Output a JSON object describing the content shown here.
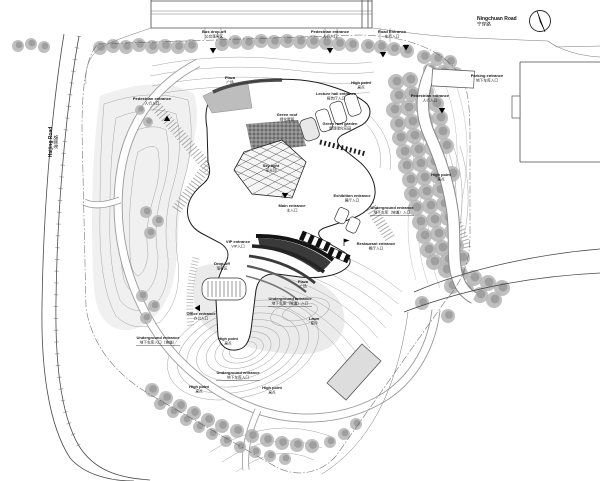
{
  "meta": {
    "title": "Architectural site plan — cultural center with landscaped park"
  },
  "colors": {
    "paper": "#ffffff",
    "ink": "#1c1c1c",
    "contour": "#a5a5a5",
    "tree": "#b3b3b3",
    "dark_canopy": "#2f2f2f",
    "plaza_gray": "#bdbdbd",
    "parcel_building": "#dddddd"
  },
  "north_arrow": {
    "name": "north-arrow"
  },
  "labels": [
    {
      "id": "ningchuan-road",
      "en": "Ningchuan Road",
      "zh": "宁穿路",
      "x": 477,
      "y": 20,
      "anchor": "start",
      "size": 5
    },
    {
      "id": "haijing-road",
      "en": "Haijing Road",
      "zh": "海景路",
      "x": 52,
      "y": 142,
      "rot": -90,
      "size": 5
    },
    {
      "id": "bus-dropoff-entrance",
      "en": "Bus drop-off",
      "zh": "公交落客区",
      "x": 214,
      "y": 33
    },
    {
      "id": "pedestrian-entrance-north",
      "en": "Pedestrian entrance",
      "zh": "人行入口",
      "x": 330,
      "y": 33
    },
    {
      "id": "road-entrance",
      "en": "Road Entrance",
      "zh": "车行入口",
      "x": 392,
      "y": 33
    },
    {
      "id": "parking-entrance-east",
      "en": "Parking entrance",
      "zh": "地下车库入口",
      "x": 487,
      "y": 77
    },
    {
      "id": "pedestrian-path-east",
      "en": "Pedestrian entrance",
      "zh": "人行入口",
      "x": 430,
      "y": 97
    },
    {
      "id": "lecture-hall-entrance",
      "en": "Lecture hall entrance",
      "zh": "报告厅入口",
      "x": 336,
      "y": 95
    },
    {
      "id": "roof-garden",
      "en": "Green roof garden",
      "zh": "屋顶绿化花园",
      "x": 340,
      "y": 125
    },
    {
      "id": "green-roof-band",
      "en": "Green roof",
      "zh": "绿化屋面",
      "x": 287,
      "y": 116
    },
    {
      "id": "plaza-north",
      "en": "Plaza",
      "zh": "广场",
      "x": 230,
      "y": 79
    },
    {
      "id": "skylight",
      "en": "Sky light",
      "zh": "采光顶",
      "x": 271,
      "y": 167
    },
    {
      "id": "main-entrance",
      "en": "Main entrance",
      "zh": "主入口",
      "x": 292,
      "y": 207
    },
    {
      "id": "exhibition-entrance",
      "en": "Exhibition entrance",
      "zh": "展厅入口",
      "x": 352,
      "y": 197
    },
    {
      "id": "underground-entrance-east",
      "en": "Underground entrance",
      "zh": "地下车库（坡道）入口",
      "x": 392,
      "y": 209,
      "u": true
    },
    {
      "id": "restaurant-entrance",
      "en": "Restaurant entrance",
      "zh": "餐厅入口",
      "x": 376,
      "y": 245
    },
    {
      "id": "high-point-ne",
      "en": "High point",
      "zh": "高点",
      "x": 441,
      "y": 176
    },
    {
      "id": "high-point-n",
      "en": "High point",
      "zh": "高点",
      "x": 361,
      "y": 84
    },
    {
      "id": "high-point-c",
      "en": "High point",
      "zh": "高点",
      "x": 228,
      "y": 340
    },
    {
      "id": "high-point-sw",
      "en": "High point",
      "zh": "高点",
      "x": 199,
      "y": 388
    },
    {
      "id": "high-point-se",
      "en": "High point",
      "zh": "高点",
      "x": 272,
      "y": 389
    },
    {
      "id": "office-entrance",
      "en": "Office entrance",
      "zh": "办公入口",
      "x": 201,
      "y": 315
    },
    {
      "id": "underground-entrance-sw",
      "en": "Underground entrance",
      "zh": "地下车库入口（坡道）",
      "x": 158,
      "y": 339,
      "u": true
    },
    {
      "id": "underground-entrance-s",
      "en": "Underground entrance",
      "zh": "地下车库（坡道）入口",
      "x": 290,
      "y": 300,
      "u": true
    },
    {
      "id": "underground-entrance-sw2",
      "en": "Underground entrance",
      "zh": "地下车库入口",
      "x": 238,
      "y": 374,
      "u": true
    },
    {
      "id": "plaza-south",
      "en": "Plaza",
      "zh": "广场",
      "x": 303,
      "y": 283
    },
    {
      "id": "lawn-south",
      "en": "Lawn",
      "zh": "草坪",
      "x": 314,
      "y": 320
    },
    {
      "id": "vip-entrance",
      "en": "VIP entrance",
      "zh": "VIP入口",
      "x": 238,
      "y": 243
    },
    {
      "id": "drop-off-west",
      "en": "Drop-off",
      "zh": "落客区",
      "x": 222,
      "y": 265
    },
    {
      "id": "pedestrian-entrance-west",
      "en": "Pedestrian entrance",
      "zh": "人行入口",
      "x": 152,
      "y": 100
    }
  ],
  "markers": [
    {
      "type": "down",
      "x": 213,
      "y": 52
    },
    {
      "type": "down",
      "x": 330,
      "y": 52
    },
    {
      "type": "down",
      "x": 406,
      "y": 49
    },
    {
      "type": "down",
      "x": 383,
      "y": 56
    },
    {
      "type": "down",
      "x": 442,
      "y": 112
    },
    {
      "type": "left",
      "x": 196,
      "y": 308
    },
    {
      "type": "flag",
      "x": 344,
      "y": 246
    },
    {
      "type": "up",
      "x": 167,
      "y": 117
    },
    {
      "type": "down",
      "x": 285,
      "y": 197
    }
  ]
}
